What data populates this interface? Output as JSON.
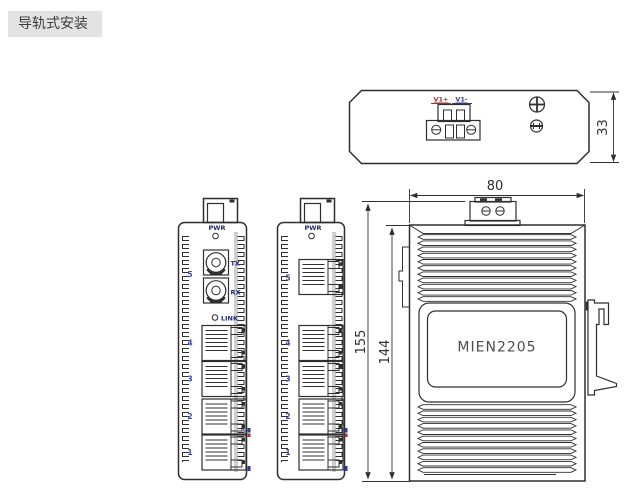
{
  "title": "导轨式安装",
  "colors": {
    "line": "#2f2f2f",
    "label": "#1f2d6e",
    "port_number": "#3548a8",
    "positive": "#a03232",
    "negative": "#30389a",
    "model_text": "#4d4d4d",
    "title_bg": "#e3e3e3"
  },
  "top_view": {
    "pos_label": "V1+",
    "neg_label": "V1-",
    "dim_depth": "33"
  },
  "side_view": {
    "model": "MIEN2205",
    "dim_width": "80",
    "dim_total": "155",
    "dim_body": "144"
  },
  "fiber_view": {
    "pwr": "PWR",
    "tx": "TX",
    "rx": "RX",
    "link": "LINK",
    "fiber_port": "5",
    "ports": [
      "4",
      "3",
      "2",
      "1"
    ]
  },
  "copper_view": {
    "pwr": "PWR",
    "uplink_port": "5",
    "ports": [
      "4",
      "3",
      "2",
      "1"
    ]
  }
}
